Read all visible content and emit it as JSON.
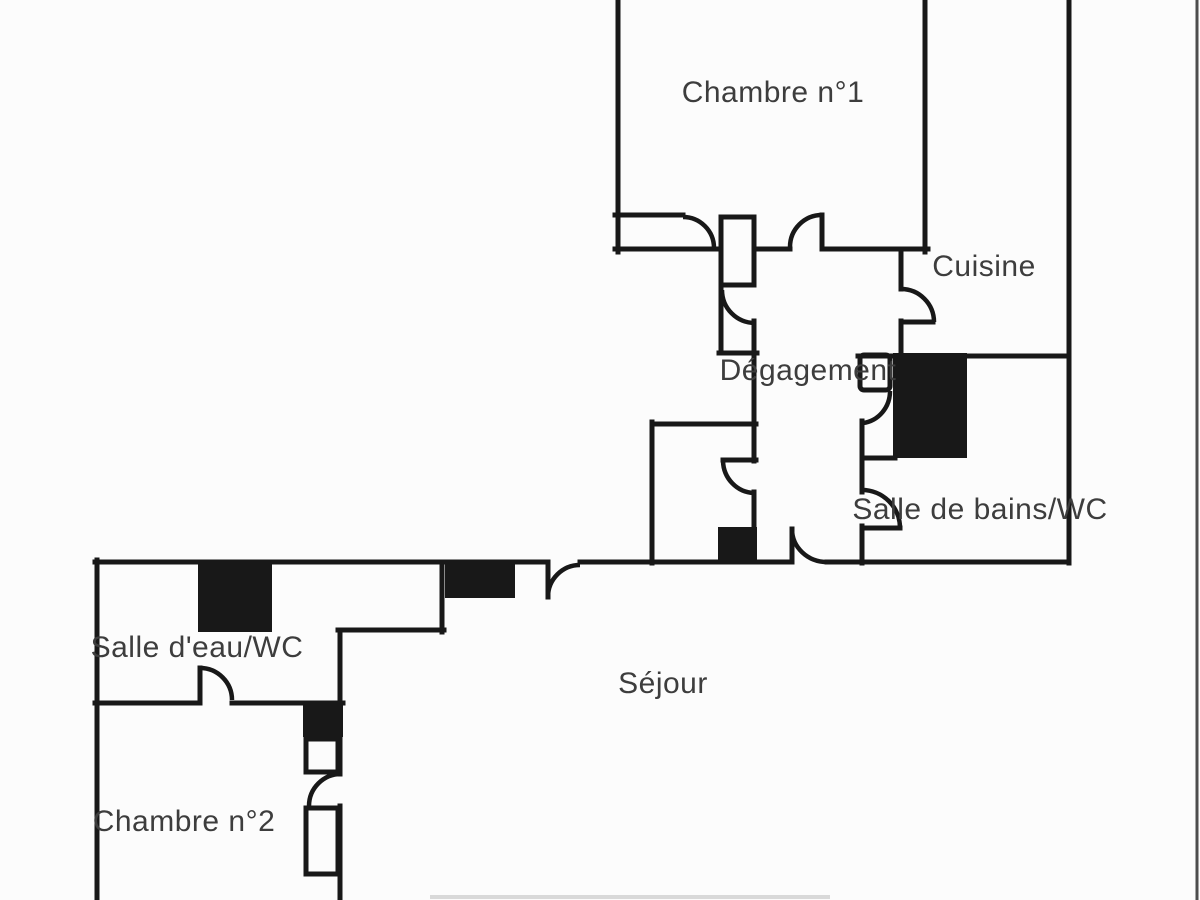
{
  "colors": {
    "wall_color": "#181818",
    "label_color": "#3d3d3d",
    "bg_color": "#fcfcfc"
  },
  "rooms": {
    "chambre1": {
      "label": "Chambre n°1"
    },
    "cuisine": {
      "label": "Cuisine"
    },
    "degagement": {
      "label": "Dégagement"
    },
    "salle_de_bains_wc": {
      "label": "Salle de bains/WC"
    },
    "salle_d_eau_wc": {
      "label": "Salle d'eau/WC"
    },
    "sejour": {
      "label": "Séjour"
    },
    "chambre2": {
      "label": "Chambre n°2"
    }
  }
}
